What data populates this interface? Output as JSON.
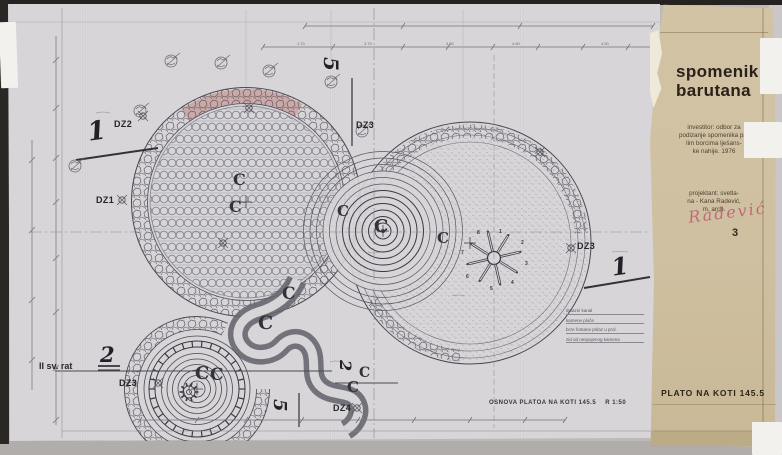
{
  "titleblock": {
    "title_lines": [
      "spomenik",
      "barutana"
    ],
    "investor_lines": [
      "investitor: odbor za",
      "podizanje spomenika pa-",
      "lim borcima lješans-",
      "ke nahije.  1976"
    ],
    "projektant_lines": [
      "projektant: svetla-",
      "na - Kana Radević,",
      "m. arch."
    ],
    "signature": "Radević",
    "sheet_number": "3",
    "plate_label": "PLATO NA KOTI  145.5"
  },
  "drawing": {
    "caption": "OSNOVA PLATOA NA KOTI  145.5",
    "scale_label": "R 1:50",
    "war_label": "II sv. rat",
    "labels": [
      {
        "text": "DZ2",
        "x": 114,
        "y": 119
      },
      {
        "text": "DZ1",
        "x": 96,
        "y": 195
      },
      {
        "text": "DZ3",
        "x": 356,
        "y": 120
      },
      {
        "text": "DZ3",
        "x": 577,
        "y": 241
      },
      {
        "text": "DZ3",
        "x": 119,
        "y": 378
      },
      {
        "text": "DZ4",
        "x": 333,
        "y": 403
      }
    ],
    "section_markers": [
      {
        "text": "1",
        "x": 86,
        "y": 120,
        "size": 26,
        "rotate": -8
      },
      {
        "text": "1",
        "x": 610,
        "y": 256,
        "size": 24,
        "rotate": -8
      },
      {
        "text": "2",
        "x": 100,
        "y": 344,
        "size": 21,
        "rotate": 0
      },
      {
        "text": "5",
        "x": 341,
        "y": 57,
        "size": 20,
        "rotate": 90
      },
      {
        "text": "5",
        "x": 288,
        "y": 399,
        "size": 18,
        "rotate": 90
      },
      {
        "text": "2",
        "x": 353,
        "y": 360,
        "size": 16,
        "rotate": 90
      }
    ],
    "center_marks": [
      {
        "text": "C",
        "x": 233,
        "y": 172,
        "size": 16
      },
      {
        "text": "C",
        "x": 229,
        "y": 199,
        "size": 16
      },
      {
        "text": "C",
        "x": 337,
        "y": 204,
        "size": 15
      },
      {
        "text": "C",
        "x": 374,
        "y": 218,
        "size": 18
      },
      {
        "text": "C",
        "x": 437,
        "y": 231,
        "size": 15
      },
      {
        "text": "C",
        "x": 282,
        "y": 286,
        "size": 17
      },
      {
        "text": "C",
        "x": 258,
        "y": 314,
        "size": 19
      },
      {
        "text": "C",
        "x": 195,
        "y": 365,
        "size": 18
      },
      {
        "text": "C",
        "x": 210,
        "y": 367,
        "size": 17
      },
      {
        "text": "C",
        "x": 359,
        "y": 366,
        "size": 14
      },
      {
        "text": "C",
        "x": 347,
        "y": 380,
        "size": 15
      }
    ],
    "star_numbers": [
      {
        "text": "1",
        "x": 499,
        "y": 229
      },
      {
        "text": "2",
        "x": 521,
        "y": 240
      },
      {
        "text": "3",
        "x": 525,
        "y": 261
      },
      {
        "text": "4",
        "x": 511,
        "y": 280
      },
      {
        "text": "5",
        "x": 490,
        "y": 286
      },
      {
        "text": "6",
        "x": 466,
        "y": 274
      },
      {
        "text": "7",
        "x": 461,
        "y": 250
      },
      {
        "text": "8",
        "x": 477,
        "y": 230
      }
    ],
    "legend_lines": [
      "dolazni kanal",
      "kamene ploče",
      "brze fontane prilaz u prol.",
      "zid od nespojenog kamena"
    ],
    "dim_numbers": [
      {
        "text": "1.70",
        "x": 297,
        "y": 41
      },
      {
        "text": "3.70",
        "x": 364,
        "y": 41
      },
      {
        "text": "4.50",
        "x": 446,
        "y": 41
      },
      {
        "text": "4.50",
        "x": 512,
        "y": 41
      },
      {
        "text": "4.50",
        "x": 601,
        "y": 41
      }
    ]
  },
  "colors": {
    "paper": "#d7d5d8",
    "tan_strip": "#cfc0a1",
    "ink": "#3c3b42",
    "signature_pink": "#c05a72",
    "backdrop": "#bdb9b6"
  }
}
